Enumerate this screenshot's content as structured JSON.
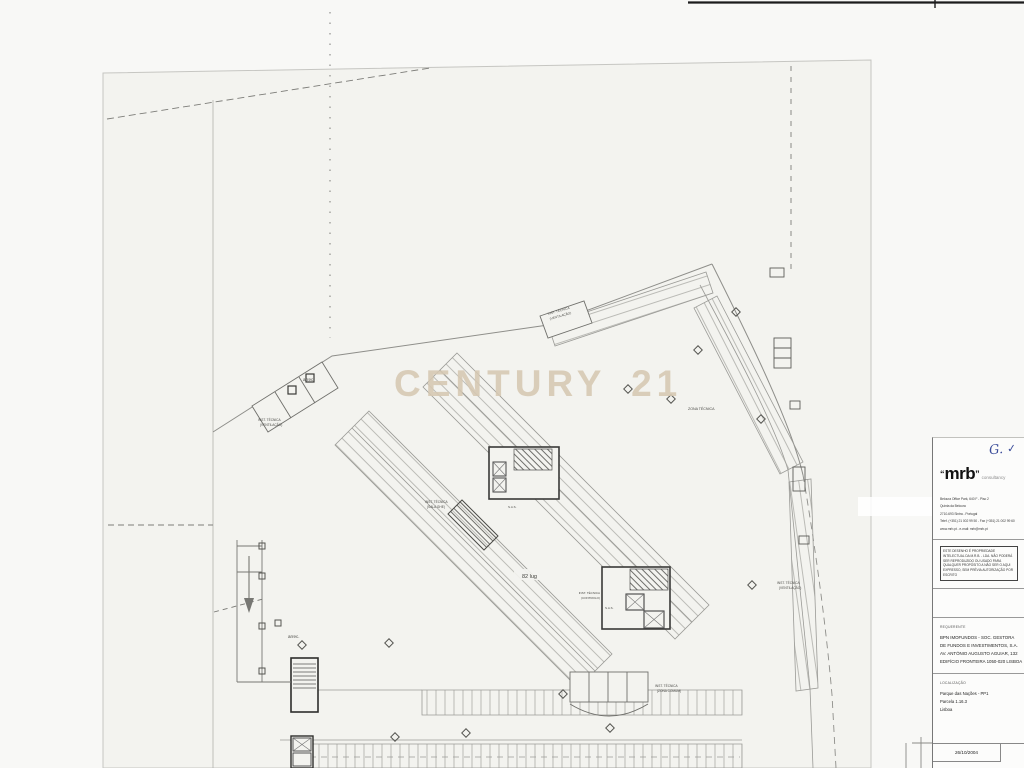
{
  "watermark": {
    "text": "CENTURY 21",
    "color": "#d6c8b2"
  },
  "plan": {
    "labels": {
      "storage_top": "arrec.",
      "tech_vent_left_1": "INST. TÉCNICA",
      "tech_vent_left_2": "(VENTILAÇÃO)",
      "tech_vent_top_1": "INST. TÉCNICA",
      "tech_vent_top_2": "(VENTILAÇÃO)",
      "zona_tecnica": "ZONA TÉCNICA",
      "tech_sala_ghe_1": "INST. TÉCNICA",
      "tech_sala_ghe_2": "(SALA GHE)",
      "capacity": "82 lug",
      "sas_a": "S.A.S.",
      "sas_b": "S.A.S.",
      "tech_controlo_1": "INST. TÉCNICA",
      "tech_controlo_2": "(CONTROLO)",
      "tech_vent_right_1": "INST. TÉCNICA",
      "tech_vent_right_2": "(VENTILAÇÃO)",
      "storage_bottom": "arrec.",
      "tech_zona_comum_1": "INST. TÉCNICA",
      "tech_zona_comum_2": "(ZONA COMUM)"
    }
  },
  "titleblock": {
    "handwritten": "G.",
    "handwritten_check": "✓",
    "logo": {
      "quote_open": "“",
      "name": "mrb",
      "quote_close": "”",
      "tagline": "consultancy"
    },
    "address": [
      "Beloura Office Park, 640 F - Piso 2",
      "Quinta da Beloura",
      "2710-693 Sintra - Portugal",
      "Telef. (+351) 21 002 99 50  -  Fax (+351) 21 002 99 60",
      "www.mrb.pt  -  e-mail: mrb@mrb.pt"
    ],
    "copyright": "Este desenho é propriedade intelectual da M.R.B. - Lda. Não poderá ser reproduzido ou usado para qualquer propósito a não ser o aqui expresso, sem prévia autorização por escrito",
    "requerente_label": "REQUERENTE",
    "requerente": [
      "BPN IMOFUNDOS - SOC. GESTORA",
      "DE FUNDOS E INVESTIMENTOS, S.A.",
      "AV. ANTÓNIO AUGUSTO AGUIAR, 132",
      "EDIFÍCIO FRONTEIRA 1050-020 LISBOA"
    ],
    "localizacao_label": "LOCALIZAÇÃO",
    "localizacao": [
      "Parque das Nações  -  PP1",
      "Parcela 1.16.3",
      "Lisboa"
    ],
    "date": "26/10/2004"
  }
}
